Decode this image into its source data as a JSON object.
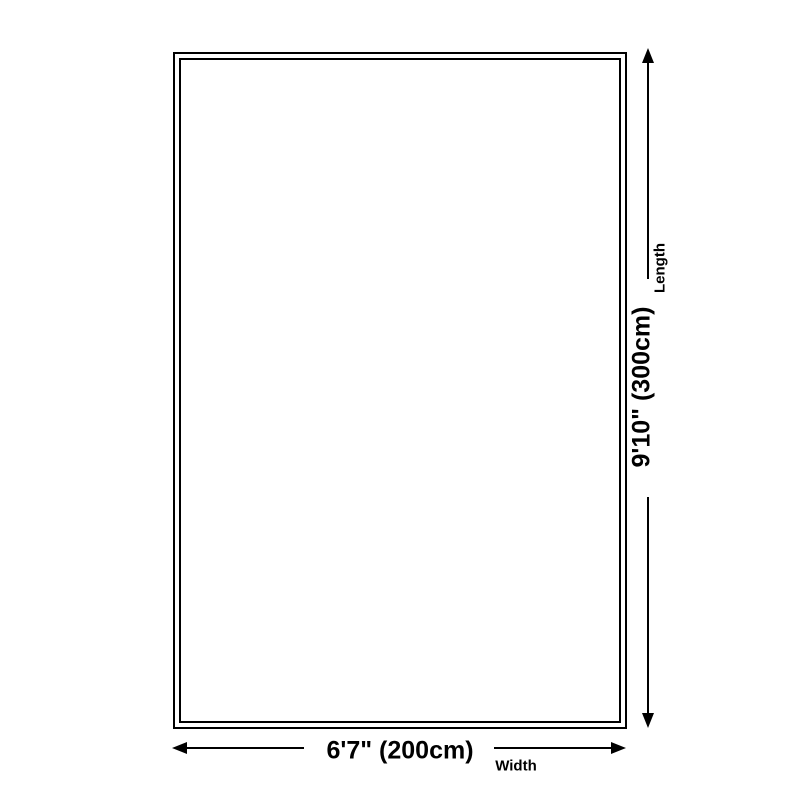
{
  "page": {
    "background_color": "#ffffff",
    "line_color": "#000000",
    "text_color": "#000000"
  },
  "rug_diagram": {
    "shape": "rectangle-double-border",
    "length_dimension": {
      "value": "9'10\" (300cm)",
      "label": "Length"
    },
    "width_dimension": {
      "value": "6'7\" (200cm)",
      "label": "Width"
    }
  }
}
